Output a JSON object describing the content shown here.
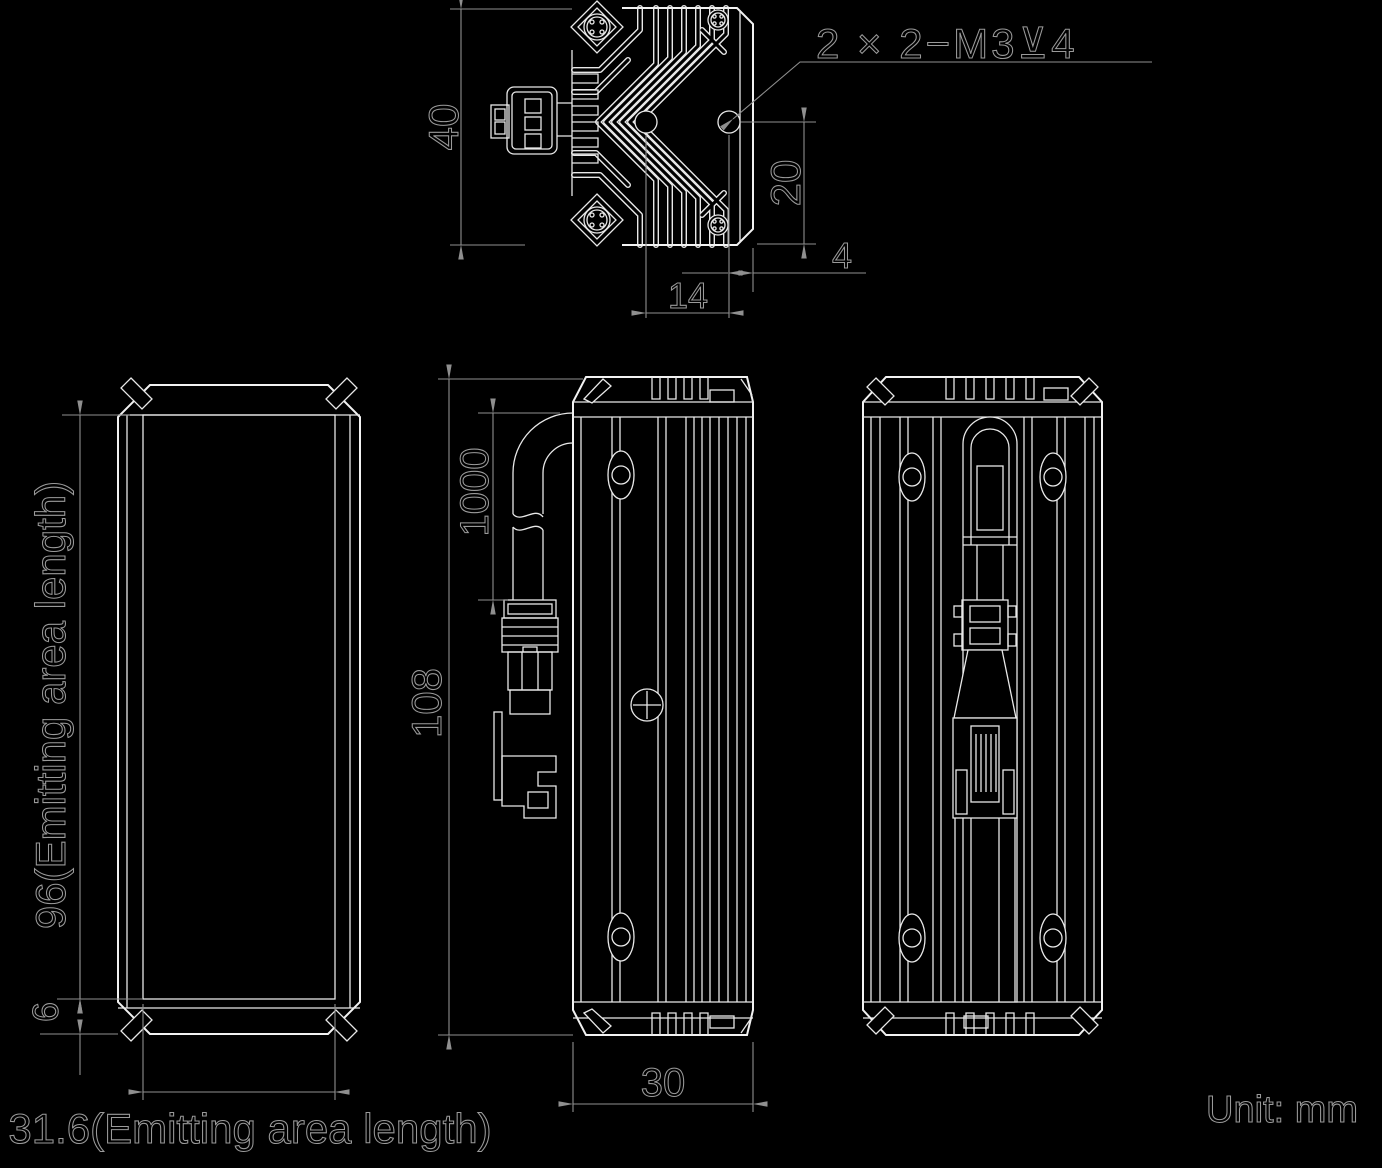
{
  "views": {
    "top_view": {
      "annotation_tapped_holes": "2 × 2−M3⊻4",
      "dim_height": "40",
      "dim_hole_to_edge_vertical": "20",
      "dim_hole_to_edge_horizontal": "4",
      "dim_hole_pitch": "14"
    },
    "front_view": {
      "dim_emitting_length": "96(Emitting area length)",
      "dim_bottom_offset": "6",
      "dim_emitting_width": "31.6(Emitting area length)"
    },
    "side_view": {
      "dim_cable_length": "1000",
      "dim_body_length": "108",
      "dim_body_width": "30"
    }
  },
  "footer": {
    "unit_label": "Unit: mm"
  },
  "colors": {
    "background": "#000000",
    "object_lines": "#e8e8e8",
    "dimension_lines": "#8f8f8f"
  }
}
